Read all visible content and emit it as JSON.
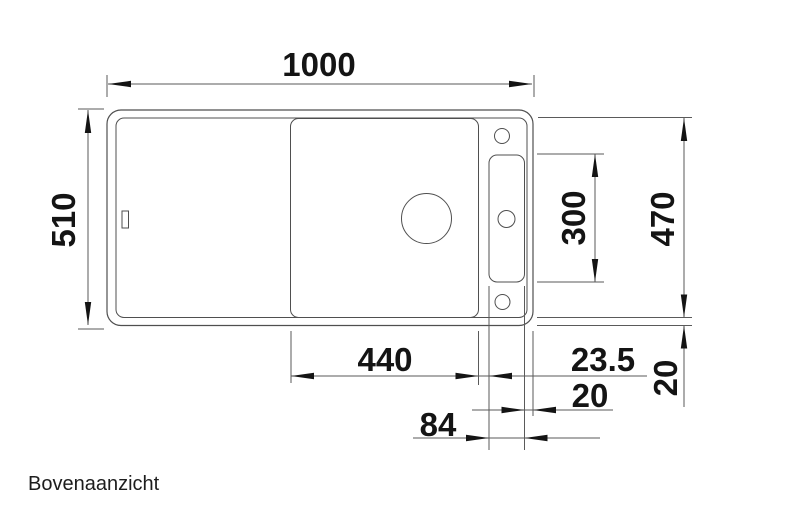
{
  "drawing": {
    "caption": "Bovenaanzicht",
    "dimension_labels": {
      "overall_width": "1000",
      "overall_depth": "510",
      "inner_length_right": "470",
      "tap_panel_length": "300",
      "bowl_width": "440",
      "bowl_to_tap_panel_gap": "23.5",
      "tap_panel_to_rim": "20",
      "tap_panel_width": "84",
      "rim_width_bottom": "20"
    },
    "colors": {
      "line": "#4f4f4f",
      "arrows_and_text": "#141414",
      "background": "#ffffff"
    }
  }
}
